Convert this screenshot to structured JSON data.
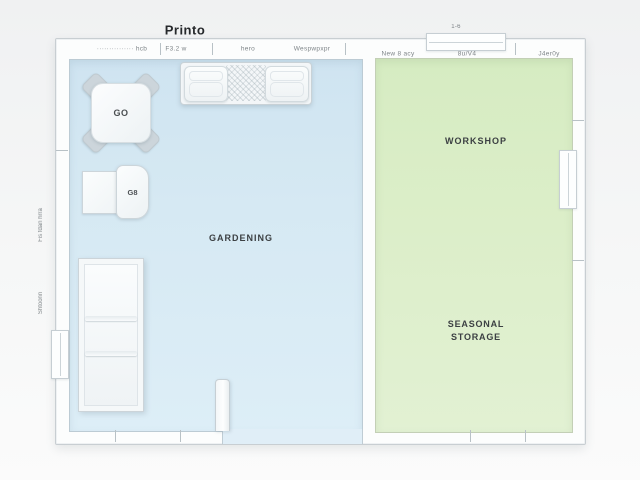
{
  "title": "Printo",
  "colors": {
    "floor_blue": "#d6e9f3",
    "floor_green": "#dceec9",
    "wall": "#fcfdfd",
    "wall_edge": "#c8ced2",
    "label_dark": "#3c4043",
    "annotation_gray": "#70777b"
  },
  "rooms": {
    "gardening": {
      "label": "GARDENING"
    },
    "workshop": {
      "label": "WORKSHOP"
    },
    "seasonal_storage": {
      "line1": "SEASONAL",
      "line2": "STORAGE"
    }
  },
  "furniture": {
    "square_table_label": "GO",
    "desk_chair_label": "G8"
  },
  "annotations": {
    "top_wall": [
      "··············· hcb",
      "F3.2 w",
      "hero",
      "Wespwpxpr",
      "New 8 acy",
      "8u/V4",
      "J4er0y"
    ],
    "left_wall_upper": "Fis fdan hrra",
    "left_wall_lower": "Shtoonn",
    "top_window": "1-6"
  }
}
